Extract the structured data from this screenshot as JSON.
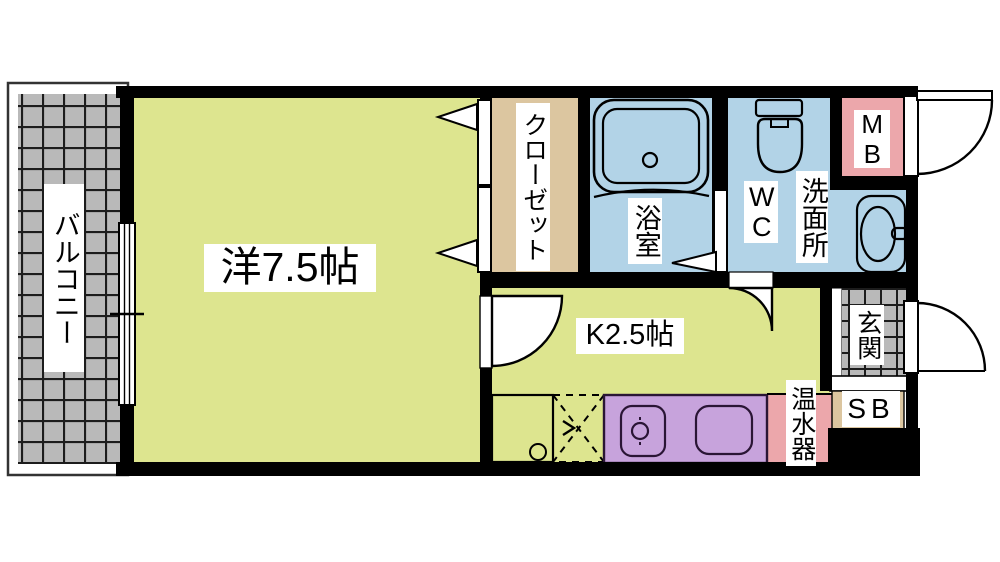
{
  "floorplan": {
    "type": "apartment-floor-plan",
    "rooms": {
      "balcony": {
        "label": "バルコニー"
      },
      "western_room": {
        "label": "洋7.5帖"
      },
      "closet": {
        "label": "クローゼット"
      },
      "bathroom": {
        "label": "浴室"
      },
      "toilet": {
        "label": "WC"
      },
      "washroom": {
        "label": "洗面所"
      },
      "meter_box": {
        "label": "MB"
      },
      "kitchen": {
        "label": "K2.5帖"
      },
      "entrance": {
        "label": "玄関"
      },
      "shoe_box": {
        "label": "SB"
      },
      "water_heater": {
        "label": "温水器"
      }
    },
    "fixtures": [
      "bathtub",
      "toilet-bowl",
      "wash-basin",
      "kitchen-sink-counter",
      "gas-burner",
      "appliance-space-dashed",
      "sliding-window",
      "entry-door-swing",
      "meter-box-door-swing",
      "interior-door-swings",
      "closet-folding-doors",
      "bathroom-door",
      "tiled-balcony-floor",
      "tiled-entrance-floor"
    ],
    "colors": {
      "yellow": "#dde58f",
      "blue": "#b2d3e7",
      "pink": "#eca7ab",
      "beige": "#dcc6a0",
      "purple": "#c7a3dc",
      "tile": "#b9b9b9",
      "wall": "#000000",
      "label_bg": "#ffffff"
    }
  }
}
